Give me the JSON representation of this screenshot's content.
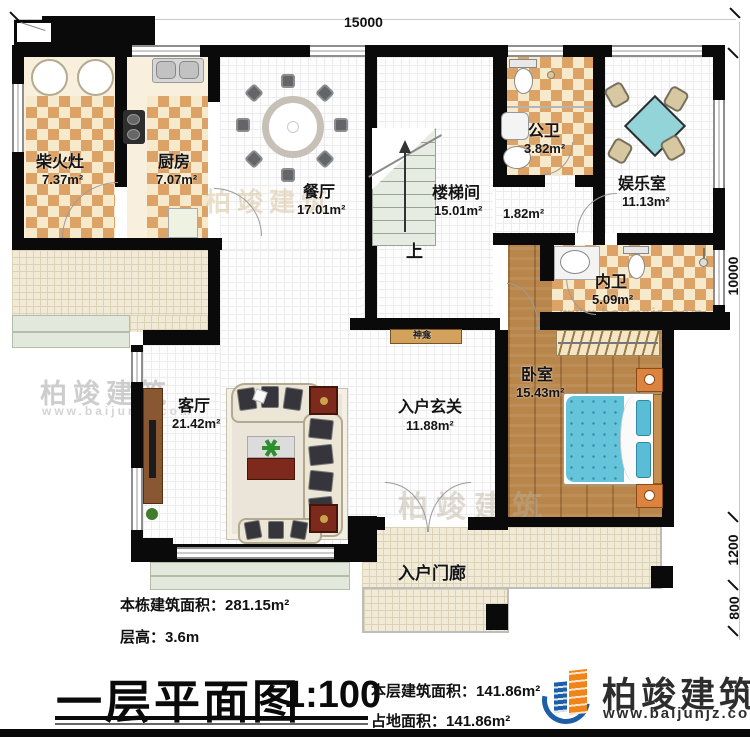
{
  "plan": {
    "title": "一层平面图",
    "scale": "1:100"
  },
  "dimensions": {
    "top": "15000",
    "right_main": "10000",
    "right_porch": "1200",
    "right_steps": "800"
  },
  "rooms": [
    {
      "name": "柴火灶",
      "area": "7.37m²"
    },
    {
      "name": "厨房",
      "area": "7.07m²"
    },
    {
      "name": "餐厅",
      "area": "17.01m²"
    },
    {
      "name": "楼梯间",
      "area": "15.01m²"
    },
    {
      "name": "公卫",
      "area": "3.82m²"
    },
    {
      "name": "娱乐室",
      "area": "11.13m²"
    },
    {
      "name": "内卫",
      "area": "5.09m²"
    },
    {
      "name": "卧室",
      "area": "15.43m²"
    },
    {
      "name": "客厅",
      "area": "21.42m²"
    },
    {
      "name": "入户玄关",
      "area": "11.88m²"
    },
    {
      "name": "",
      "area": "1.82m²"
    },
    {
      "name": "入户门廊",
      "area": ""
    }
  ],
  "labels": {
    "shrine": "神龛",
    "stairs_up": "上"
  },
  "info": {
    "building_area_label": "本栋建筑面积：",
    "building_area_value": "281.15m²",
    "floor_height_label": "层高：",
    "floor_height_value": "3.6m",
    "floor_area_label": "本层建筑面积：",
    "floor_area_value": "141.86m²",
    "footprint_label": "占地面积：",
    "footprint_value": "141.86m²"
  },
  "brand": {
    "name": "柏竣建筑",
    "url": "www.baijunjz.com"
  },
  "colors": {
    "wall": "#0a0a0a",
    "checker_tile": "#dca266",
    "cream_floor": "#f8efdc",
    "wood_floor": "#b8854b",
    "teal_furniture": "#92d4d8",
    "mattress_teal": "#66c4da",
    "nightstand_orange": "#dd8340",
    "side_table_red": "#7d2a1c",
    "brand_blue": "#1d5ea7",
    "brand_orange": "#ef8418"
  }
}
